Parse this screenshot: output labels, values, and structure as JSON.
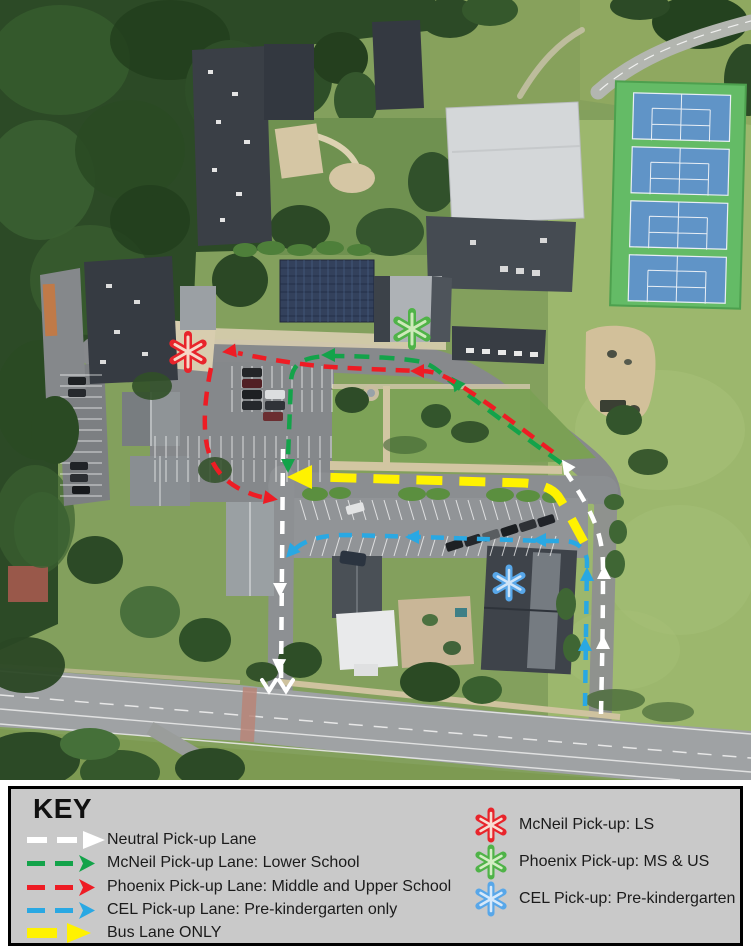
{
  "key": {
    "title": "KEY",
    "lanes": [
      {
        "id": "neutral",
        "label": "Neutral Pick-up Lane",
        "color": "#ffffff"
      },
      {
        "id": "mcneil",
        "label": "McNeil Pick-up Lane: Lower School",
        "color": "#13a34a"
      },
      {
        "id": "phoenix",
        "label": "Phoenix Pick-up Lane: Middle and Upper School",
        "color": "#ee1c24"
      },
      {
        "id": "cel",
        "label": "CEL Pick-up Lane: Pre-kindergarten only",
        "color": "#29a8e3"
      },
      {
        "id": "bus",
        "label": "Bus Lane ONLY",
        "color": "#fff200"
      }
    ],
    "pickup_points": [
      {
        "id": "mcneil-ls",
        "label": "McNeil Pick-up: LS",
        "color": "#e8242b"
      },
      {
        "id": "phoenix-ms-us",
        "label": "Phoenix Pick-up: MS & US",
        "color": "#4fb348"
      },
      {
        "id": "cel-prek",
        "label": "CEL Pick-up: Pre-kindergarten",
        "color": "#58a7e9"
      }
    ]
  },
  "map": {
    "routes": [
      {
        "id": "neutral-lane",
        "color": "#ffffff"
      },
      {
        "id": "mcneil-lane",
        "color": "#13a34a"
      },
      {
        "id": "phoenix-lane",
        "color": "#ee1c24"
      },
      {
        "id": "cel-lane",
        "color": "#29a8e3"
      },
      {
        "id": "bus-lane",
        "color": "#fff200"
      }
    ],
    "markers": [
      {
        "id": "mcneil-ls-pickup",
        "color": "#e8242b"
      },
      {
        "id": "phoenix-ms-us-pickup",
        "color": "#4fb348"
      },
      {
        "id": "cel-prek-pickup",
        "color": "#58a7e9"
      }
    ]
  }
}
